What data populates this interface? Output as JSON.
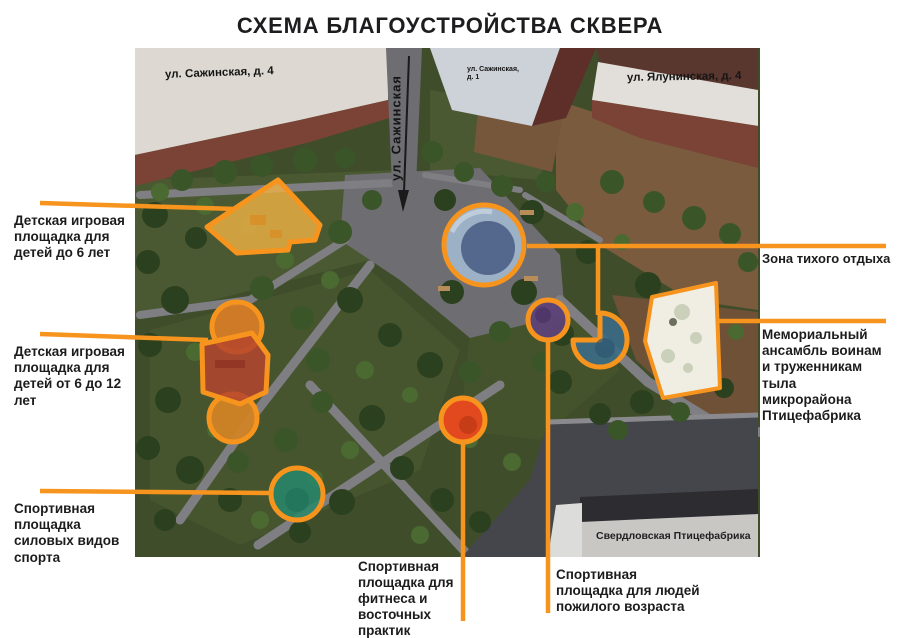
{
  "title": "СХЕМА БЛАГОУСТРОЙСТВА СКВЕРА",
  "colors": {
    "accent": "#F7941D",
    "arrow": "#1A1A1A",
    "play_under6": "#F0B245",
    "play_6_12_main": "#B4452E",
    "play_6_12_circle_top": "#DE7E27",
    "play_6_12_circle_bottom": "#D28426",
    "pond_outer": "#9DB1C6",
    "pond_inner": "#54678C",
    "elderly": "#5E4379",
    "quiet_wedge": "#3C6B86",
    "fitness": "#E2491F",
    "strength": "#27876B",
    "memorial": "#F0EDE2"
  },
  "streets": {
    "sazhinskaya_4": "ул. Сажинская, д. 4",
    "sazhinskaya_vertical": "ул. Сажинская",
    "sazhinskaya_1": "ул. Сажинская,\nд. 1",
    "yaluninskaya_4": "ул. Ялунинская, д. 4",
    "factory": "Свердловская Птицефабрика"
  },
  "callouts": {
    "play_under6": "Детская игровая\nплощадка для\nдетей до 6 лет",
    "play_6_12": "Детская игровая\nплощадка для\nдетей от 6 до 12\nлет",
    "strength": "Спортивная\nплощадка\nсиловых видов\nспорта",
    "quiet": "Зона тихого отдыха",
    "memorial": "Мемориальный\nансамбль  воинам\nи труженникам\nтыла\nмикрорайона\nПтицефабрика",
    "fitness": "Спортивная\nплощадка для\nфитнеса и\nвосточных\nпрактик",
    "elderly": "Спортивная\nплощадка для людей\nпожилого возраста"
  }
}
